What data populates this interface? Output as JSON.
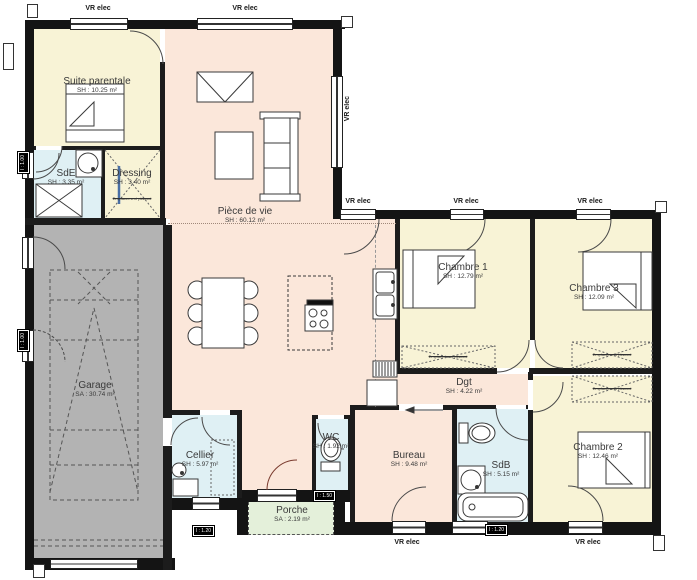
{
  "plan": {
    "rooms": [
      {
        "id": "suite-parentale",
        "name": "Suite parentale",
        "area": "SH : 10.25 m²"
      },
      {
        "id": "sde",
        "name": "SdE",
        "area": "SH : 3.35 m²"
      },
      {
        "id": "dressing",
        "name": "Dressing",
        "area": "SH : 3.40 m²"
      },
      {
        "id": "piece-de-vie",
        "name": "Pièce de vie",
        "area": "SH : 60.12 m²"
      },
      {
        "id": "garage",
        "name": "Garage",
        "area": "SA : 30.74 m²"
      },
      {
        "id": "chambre-1",
        "name": "Chambre 1",
        "area": "SH : 12.79 m²"
      },
      {
        "id": "chambre-3",
        "name": "Chambre 3",
        "area": "SH : 12.09 m²"
      },
      {
        "id": "chambre-2",
        "name": "Chambre 2",
        "area": "SH : 12.46 m²"
      },
      {
        "id": "dgt",
        "name": "Dgt",
        "area": "SH : 4.22 m²"
      },
      {
        "id": "bureau",
        "name": "Bureau",
        "area": "SH : 9.48 m²"
      },
      {
        "id": "sdb",
        "name": "SdB",
        "area": "SH : 5.15 m²"
      },
      {
        "id": "wc",
        "name": "WC",
        "area": "SH : 1.92 m²"
      },
      {
        "id": "cellier",
        "name": "Cellier",
        "area": "SH : 5.97 m²"
      },
      {
        "id": "porche",
        "name": "Porche",
        "area": "SA : 2.19 m²"
      }
    ],
    "labels": {
      "vr_elec": "VR elec",
      "placard": "Emplacement placard"
    },
    "dims": {
      "w100": "l : 1.00",
      "w120": "l : 1.20",
      "w150": "l : 1.50"
    },
    "colors": {
      "wall": "#141414",
      "bedroom_fill": "#f8f3d6",
      "living_fill": "#fbe7da",
      "water_fill": "#dff0f4",
      "garage_fill": "#b3b3b3",
      "porch_fill": "#e4f0da"
    }
  }
}
